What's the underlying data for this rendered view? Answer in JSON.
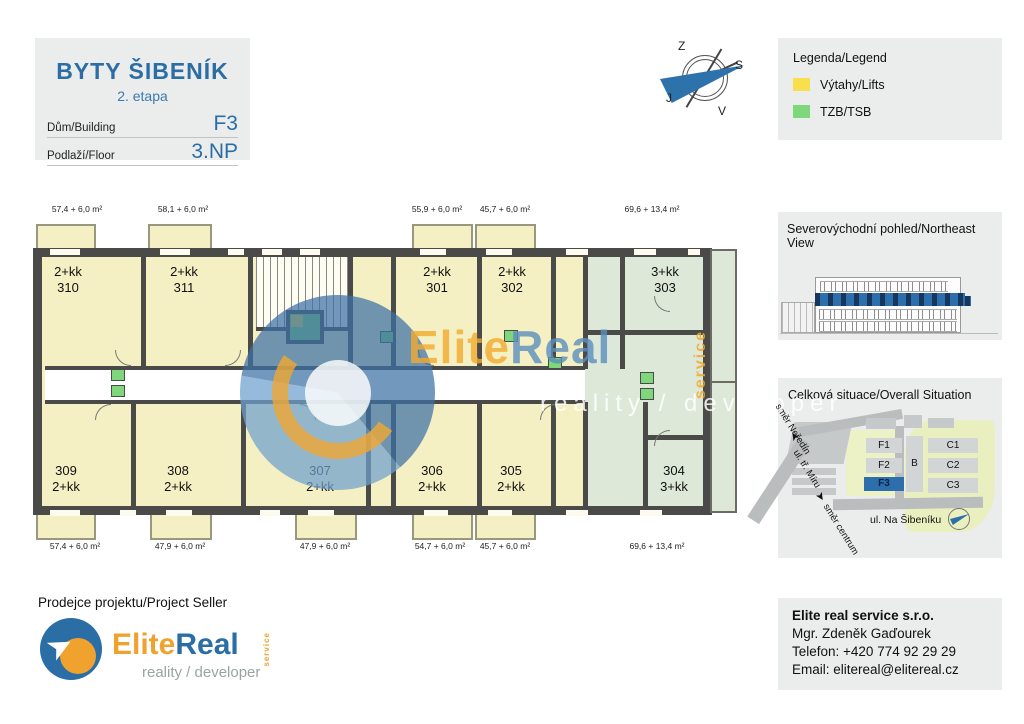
{
  "header": {
    "title": "BYTY ŠIBENÍK",
    "subtitle": "2. etapa",
    "building_label": "Dům/Building",
    "building_value": "F3",
    "floor_label": "Podlaží/Floor",
    "floor_value": "3.NP"
  },
  "compass": {
    "top": "Z",
    "right": "S",
    "left": "J",
    "bottom": "V"
  },
  "legend": {
    "title": "Legenda/Legend",
    "items": [
      {
        "label": "Výtahy/Lifts",
        "color": "#f8df4d"
      },
      {
        "label": "TZB/TSB",
        "color": "#7ed87b"
      }
    ]
  },
  "floorplan": {
    "units": [
      {
        "number": "310",
        "type": "2+kk",
        "area": "57,4 + 6,0 m²"
      },
      {
        "number": "311",
        "type": "2+kk",
        "area": "58,1 + 6,0 m²"
      },
      {
        "number": "301",
        "type": "2+kk",
        "area": "55,9 + 6,0 m²"
      },
      {
        "number": "302",
        "type": "2+kk",
        "area": "45,7 + 6,0 m²"
      },
      {
        "number": "303",
        "type": "3+kk",
        "area": "69,6 + 13,4 m²"
      },
      {
        "number": "309",
        "type": "2+kk",
        "area": "57,4 + 6,0 m²"
      },
      {
        "number": "308",
        "type": "2+kk",
        "area": "47,9 + 6,0 m²"
      },
      {
        "number": "307",
        "type": "2+kk",
        "area": "47,9 + 6,0 m²"
      },
      {
        "number": "306",
        "type": "2+kk",
        "area": "54,7 + 6,0 m²"
      },
      {
        "number": "305",
        "type": "2+kk",
        "area": "45,7 + 6,0 m²"
      },
      {
        "number": "304",
        "type": "3+kk",
        "area": "69,6 + 13,4 m²"
      }
    ],
    "watermark": {
      "brand_left": "Elite",
      "brand_right": "Real",
      "service": "service",
      "tagline": "reality / developer"
    },
    "colors": {
      "room": "#f5f0c4",
      "room_green": "#dde8d8",
      "wall": "#4a4a48",
      "lift": "#f8df4d",
      "tzb": "#7ed87b"
    }
  },
  "northeast_view": {
    "title": "Severovýchodní pohled/Northeast View"
  },
  "situation": {
    "title": "Celková situace/Overall Situation",
    "buildings": [
      "F1",
      "F2",
      "F3",
      "B",
      "C1",
      "C2",
      "C3"
    ],
    "highlighted": "F3",
    "streets": {
      "nederin": "směr Neředín",
      "miru": "ul. tř. Míru",
      "centrum": "směr centrum",
      "sibeniku": "ul. Na Šibeníku"
    }
  },
  "seller": {
    "label": "Prodejce projektu/Project Seller",
    "brand_left": "Elite",
    "brand_right": "Real",
    "service": "service",
    "tagline": "reality / developer"
  },
  "contact": {
    "company": "Elite real service s.r.o.",
    "person": "Mgr. Zdeněk Gaďourek",
    "phone": "Telefon: +420 774 92 29 29",
    "email": "Email: elitereal@elitereal.cz"
  }
}
